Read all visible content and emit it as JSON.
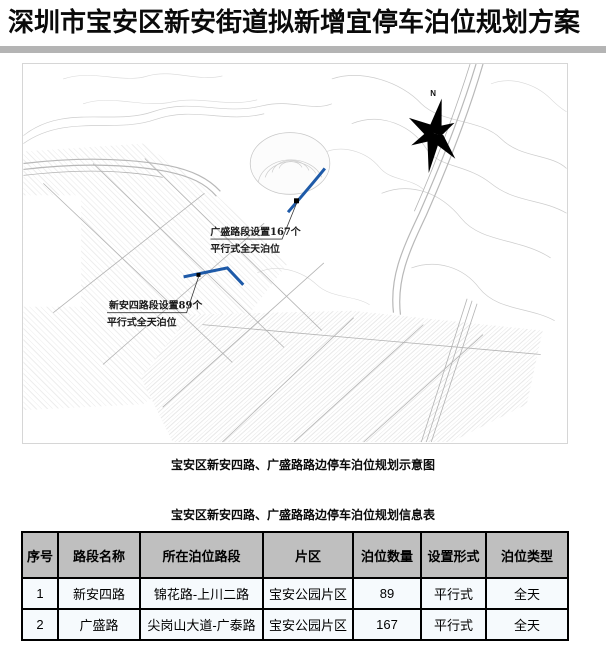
{
  "page": {
    "title": "深圳市宝安区新安街道拟新增宜停车泊位规划方案"
  },
  "theme": {
    "header_bg": "#bfbfbf",
    "row_bg": "#f6fafd",
    "divider_gray": "#b4b4b4",
    "road_highlight": "#1e5aa8",
    "ink": "#000000"
  },
  "map": {
    "caption": "宝安区新安四路、广盛路路边停车泊位规划示意图",
    "compass_label": "N",
    "annotations": [
      {
        "road": "广盛路",
        "line1": "广盛路段设置167个",
        "line2": "平行式全天泊位"
      },
      {
        "road": "新安四路",
        "line1": "新安四路段设置89个",
        "line2": "平行式全天泊位"
      }
    ]
  },
  "table": {
    "title": "宝安区新安四路、广盛路路边停车泊位规划信息表",
    "headers": [
      "序号",
      "路段名称",
      "所在泊位路段",
      "片区",
      "泊位数量",
      "设置形式",
      "泊位类型"
    ],
    "rows": [
      [
        "1",
        "新安四路",
        "锦花路-上川二路",
        "宝安公园片区",
        "89",
        "平行式",
        "全天"
      ],
      [
        "2",
        "广盛路",
        "尖岗山大道-广泰路",
        "宝安公园片区",
        "167",
        "平行式",
        "全天"
      ]
    ]
  }
}
